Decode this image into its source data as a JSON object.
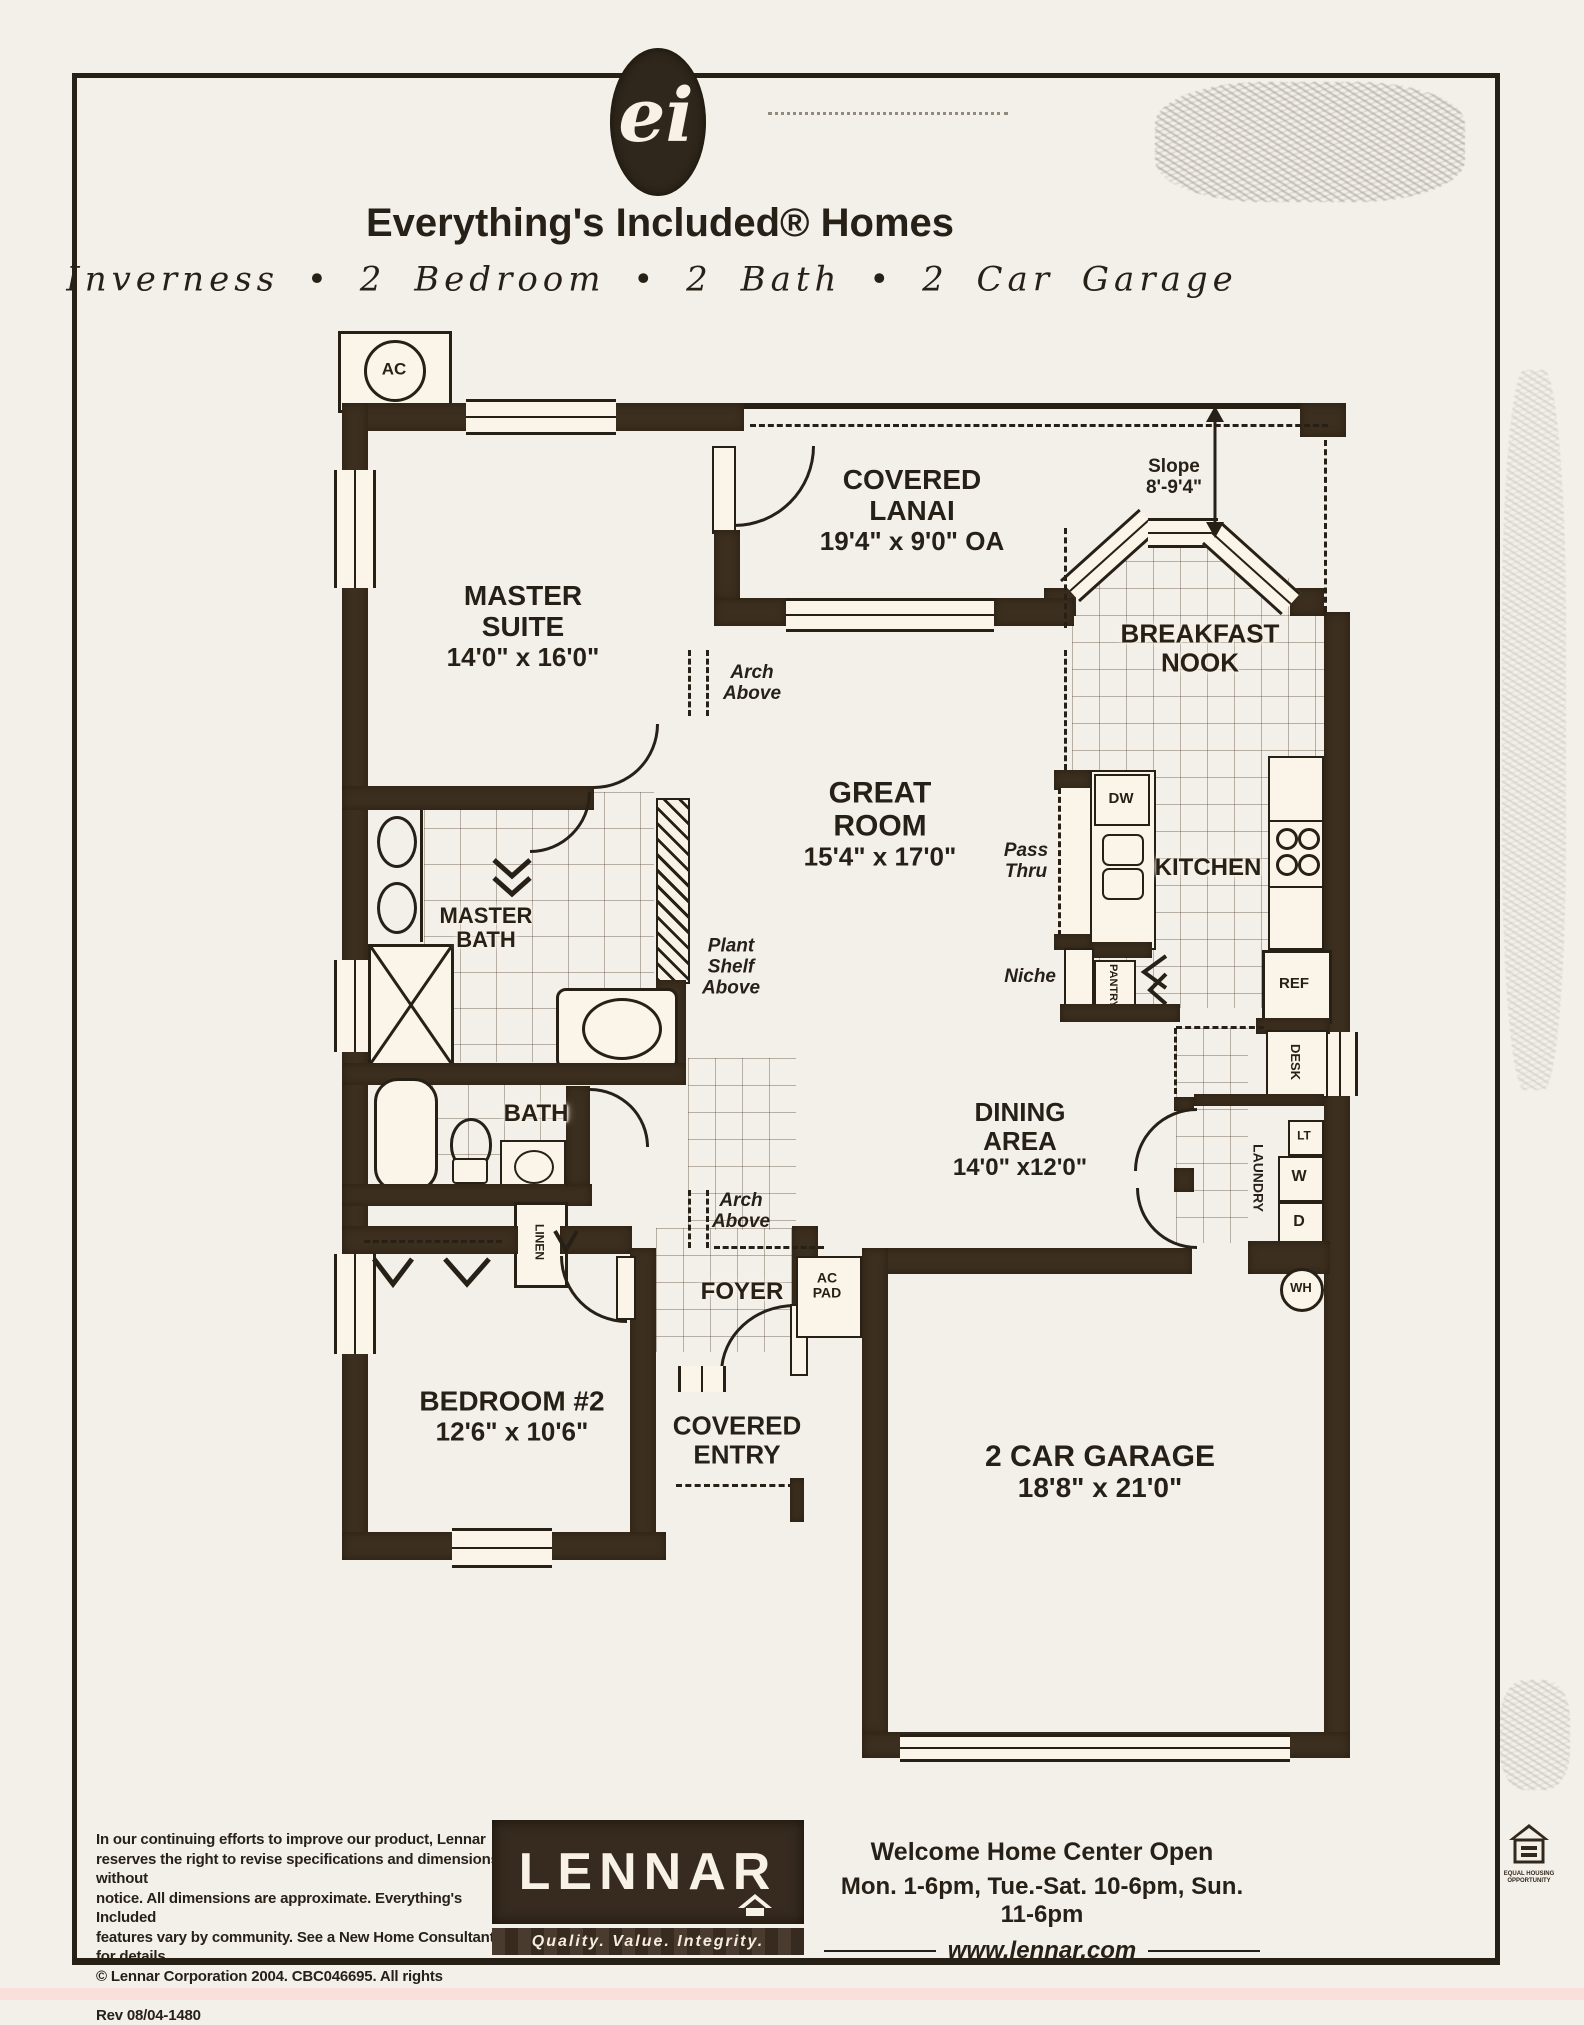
{
  "header": {
    "logo_text": "ei",
    "title": "Everything's Included® Homes",
    "subtitle": "Inverness  •  2 Bedroom  •  2 Bath  •  2 Car Garage"
  },
  "plan": {
    "rooms": {
      "master_suite": {
        "line1": "MASTER",
        "line2": "SUITE",
        "dims": "14'0\" x 16'0\""
      },
      "covered_lanai": {
        "line1": "COVERED",
        "line2": "LANAI",
        "dims": "19'4\" x 9'0\" OA"
      },
      "breakfast_nook": {
        "line1": "BREAKFAST",
        "line2": "NOOK"
      },
      "great_room": {
        "line1": "GREAT",
        "line2": "ROOM",
        "dims": "15'4\" x 17'0\""
      },
      "kitchen": {
        "name": "KITCHEN"
      },
      "master_bath": {
        "line1": "MASTER",
        "line2": "BATH"
      },
      "bath": {
        "name": "BATH"
      },
      "dining_area": {
        "line1": "DINING",
        "line2": "AREA",
        "dims": "14'0\" x12'0\""
      },
      "foyer": {
        "name": "FOYER"
      },
      "bedroom_2": {
        "name": "BEDROOM #2",
        "dims": "12'6\" x 10'6\""
      },
      "covered_entry": {
        "line1": "COVERED",
        "line2": "ENTRY"
      },
      "garage": {
        "name": "2 CAR GARAGE",
        "dims": "18'8\" x 21'0\""
      }
    },
    "annotations": {
      "slope": {
        "line1": "Slope",
        "line2": "8'-9'4\""
      },
      "arch_above": {
        "line1": "Arch",
        "line2": "Above"
      },
      "plant_shelf": {
        "line1": "Plant",
        "line2": "Shelf",
        "line3": "Above"
      },
      "pass_thru": {
        "line1": "Pass",
        "line2": "Thru"
      },
      "niche": "Niche",
      "ac_unit": "AC",
      "ac_pad": {
        "line1": "AC",
        "line2": "PAD"
      },
      "water_heater": "WH",
      "dishwasher": "DW",
      "refrigerator": "REF",
      "desk": "DESK",
      "pantry": "PANTRY",
      "laundry": "LAUNDRY",
      "laundry_tub": "LT",
      "washer": "W",
      "dryer": "D",
      "linen": "LINEN"
    }
  },
  "footer": {
    "disclaimer_lines": [
      "In our continuing efforts to improve our product, Lennar",
      "reserves the right to revise specifications and dimensions without",
      "notice. All dimensions are approximate. Everything's Included",
      "features vary by community. See a New Home Consultant for details."
    ],
    "copyright": "© Lennar Corporation 2004. CBC046695. All rights reserved.",
    "revision": "Rev 08/04-1480",
    "brand": "LENNAR",
    "tagline": "Quality. Value. Integrity.",
    "welcome": "Welcome Home Center Open",
    "hours": "Mon. 1-6pm, Tue.-Sat. 10-6pm, Sun. 11-6pm",
    "website": "www.lennar.com",
    "equal_housing": "EQUAL HOUSING OPPORTUNITY"
  },
  "colors": {
    "wall": "#3a2b1a",
    "paper": "#f3f0ea",
    "ink": "#241c13"
  }
}
